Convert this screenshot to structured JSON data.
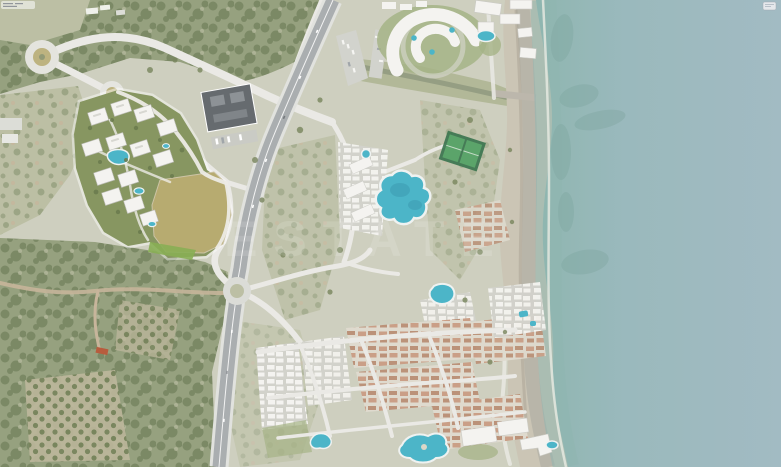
{
  "meta": {
    "view": "aerial-satellite-map",
    "width": 781,
    "height": 467,
    "description": "Satellite photo of a coastal resort strip with a rendered new-development site plan highlighted in the north-west corner, a vacant tan plot beside it, a motorway with roundabouts, resort pools, dense townhouse clusters, a pebble beach and the sea on the east side"
  },
  "watermark": {
    "text": "ESTATE"
  },
  "ui": {
    "attribution": {
      "present": true,
      "legible": false
    },
    "inset_widget_icon": {
      "present": true,
      "shape": "small-light-rounded-rectangle"
    }
  },
  "features": {
    "development_site": "rendered masterplan: white villa blocks, landscaped gardens, turquoise pools",
    "vacant_plot": "large tan/olive empty parcel south-east of the rendered site",
    "roundabouts": 3,
    "motorway": "dual carriageway running north-south on the left-center",
    "dark_building": "dark flat-roof commercial building north-east of the site",
    "crescent_complex": "curved white apartment complex at top-center",
    "river": "dry riverbed reaching the sea at top-right",
    "resort": "hotel resort with large irregular turquoise pools and tennis courts mid-map",
    "urban_cluster": "dense terracotta-roof townhouses in the lower center",
    "beach": "grey-sand pebble beach strip",
    "sea": "pale teal sea occupying the right edge"
  },
  "colors": {
    "land_base": "#cbccbb",
    "forest_dark": "#71805a",
    "forest_mid": "#8f9a76",
    "scrub_light": "#b7bb9e",
    "dirt": "#c3b094",
    "road_light": "#e9e8e3",
    "highway": "#a4a8aa",
    "sea_far": "#9bb6bf",
    "sea_mid": "#93b4b8",
    "sea_near": "#87b1ab",
    "sea_dark_patch": "#78a19b",
    "surf": "#e7eae1",
    "beach_sand": "#c7c1b0",
    "beach_pebble": "#aeaba0",
    "pool": "#3fb0c4",
    "pool_deep": "#2e93ab",
    "dev_plot": "#b2a566",
    "dev_green": "#7e8f55",
    "garden_green": "#9fae7e",
    "bright_green": "#7fa848",
    "building_white": "#f4f3ef",
    "building_line": "#bcbcb6",
    "roof_terra": "#c6987e",
    "roof_terra2": "#b68a6f",
    "dark_roof": "#5b6065",
    "court_green": "#4f9e5f",
    "court_dark": "#2e6b43",
    "watermark_color": "#ffffff"
  }
}
